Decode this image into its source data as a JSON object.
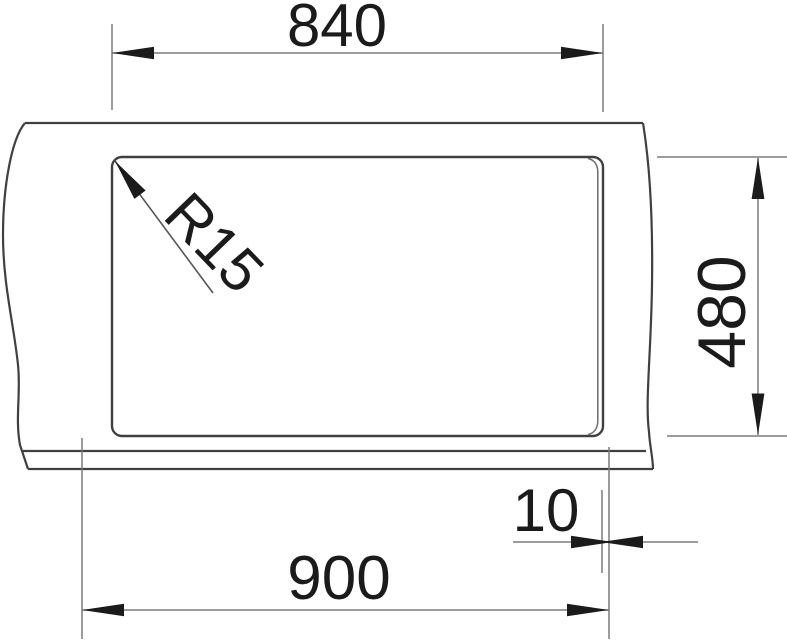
{
  "drawing": {
    "labels": {
      "cutout_width": "840",
      "cutout_depth": "480",
      "overall_width": "900",
      "edge_offset": "10",
      "corner_radius": "R15"
    },
    "colors": {
      "background": "#ffffff",
      "object_line": "#404040",
      "dimension_line": "#7b7b7b",
      "leader_line": "#565656",
      "inner_edge_line": "#6e6e6e",
      "arrow_and_text": "#1b1b1b"
    }
  }
}
